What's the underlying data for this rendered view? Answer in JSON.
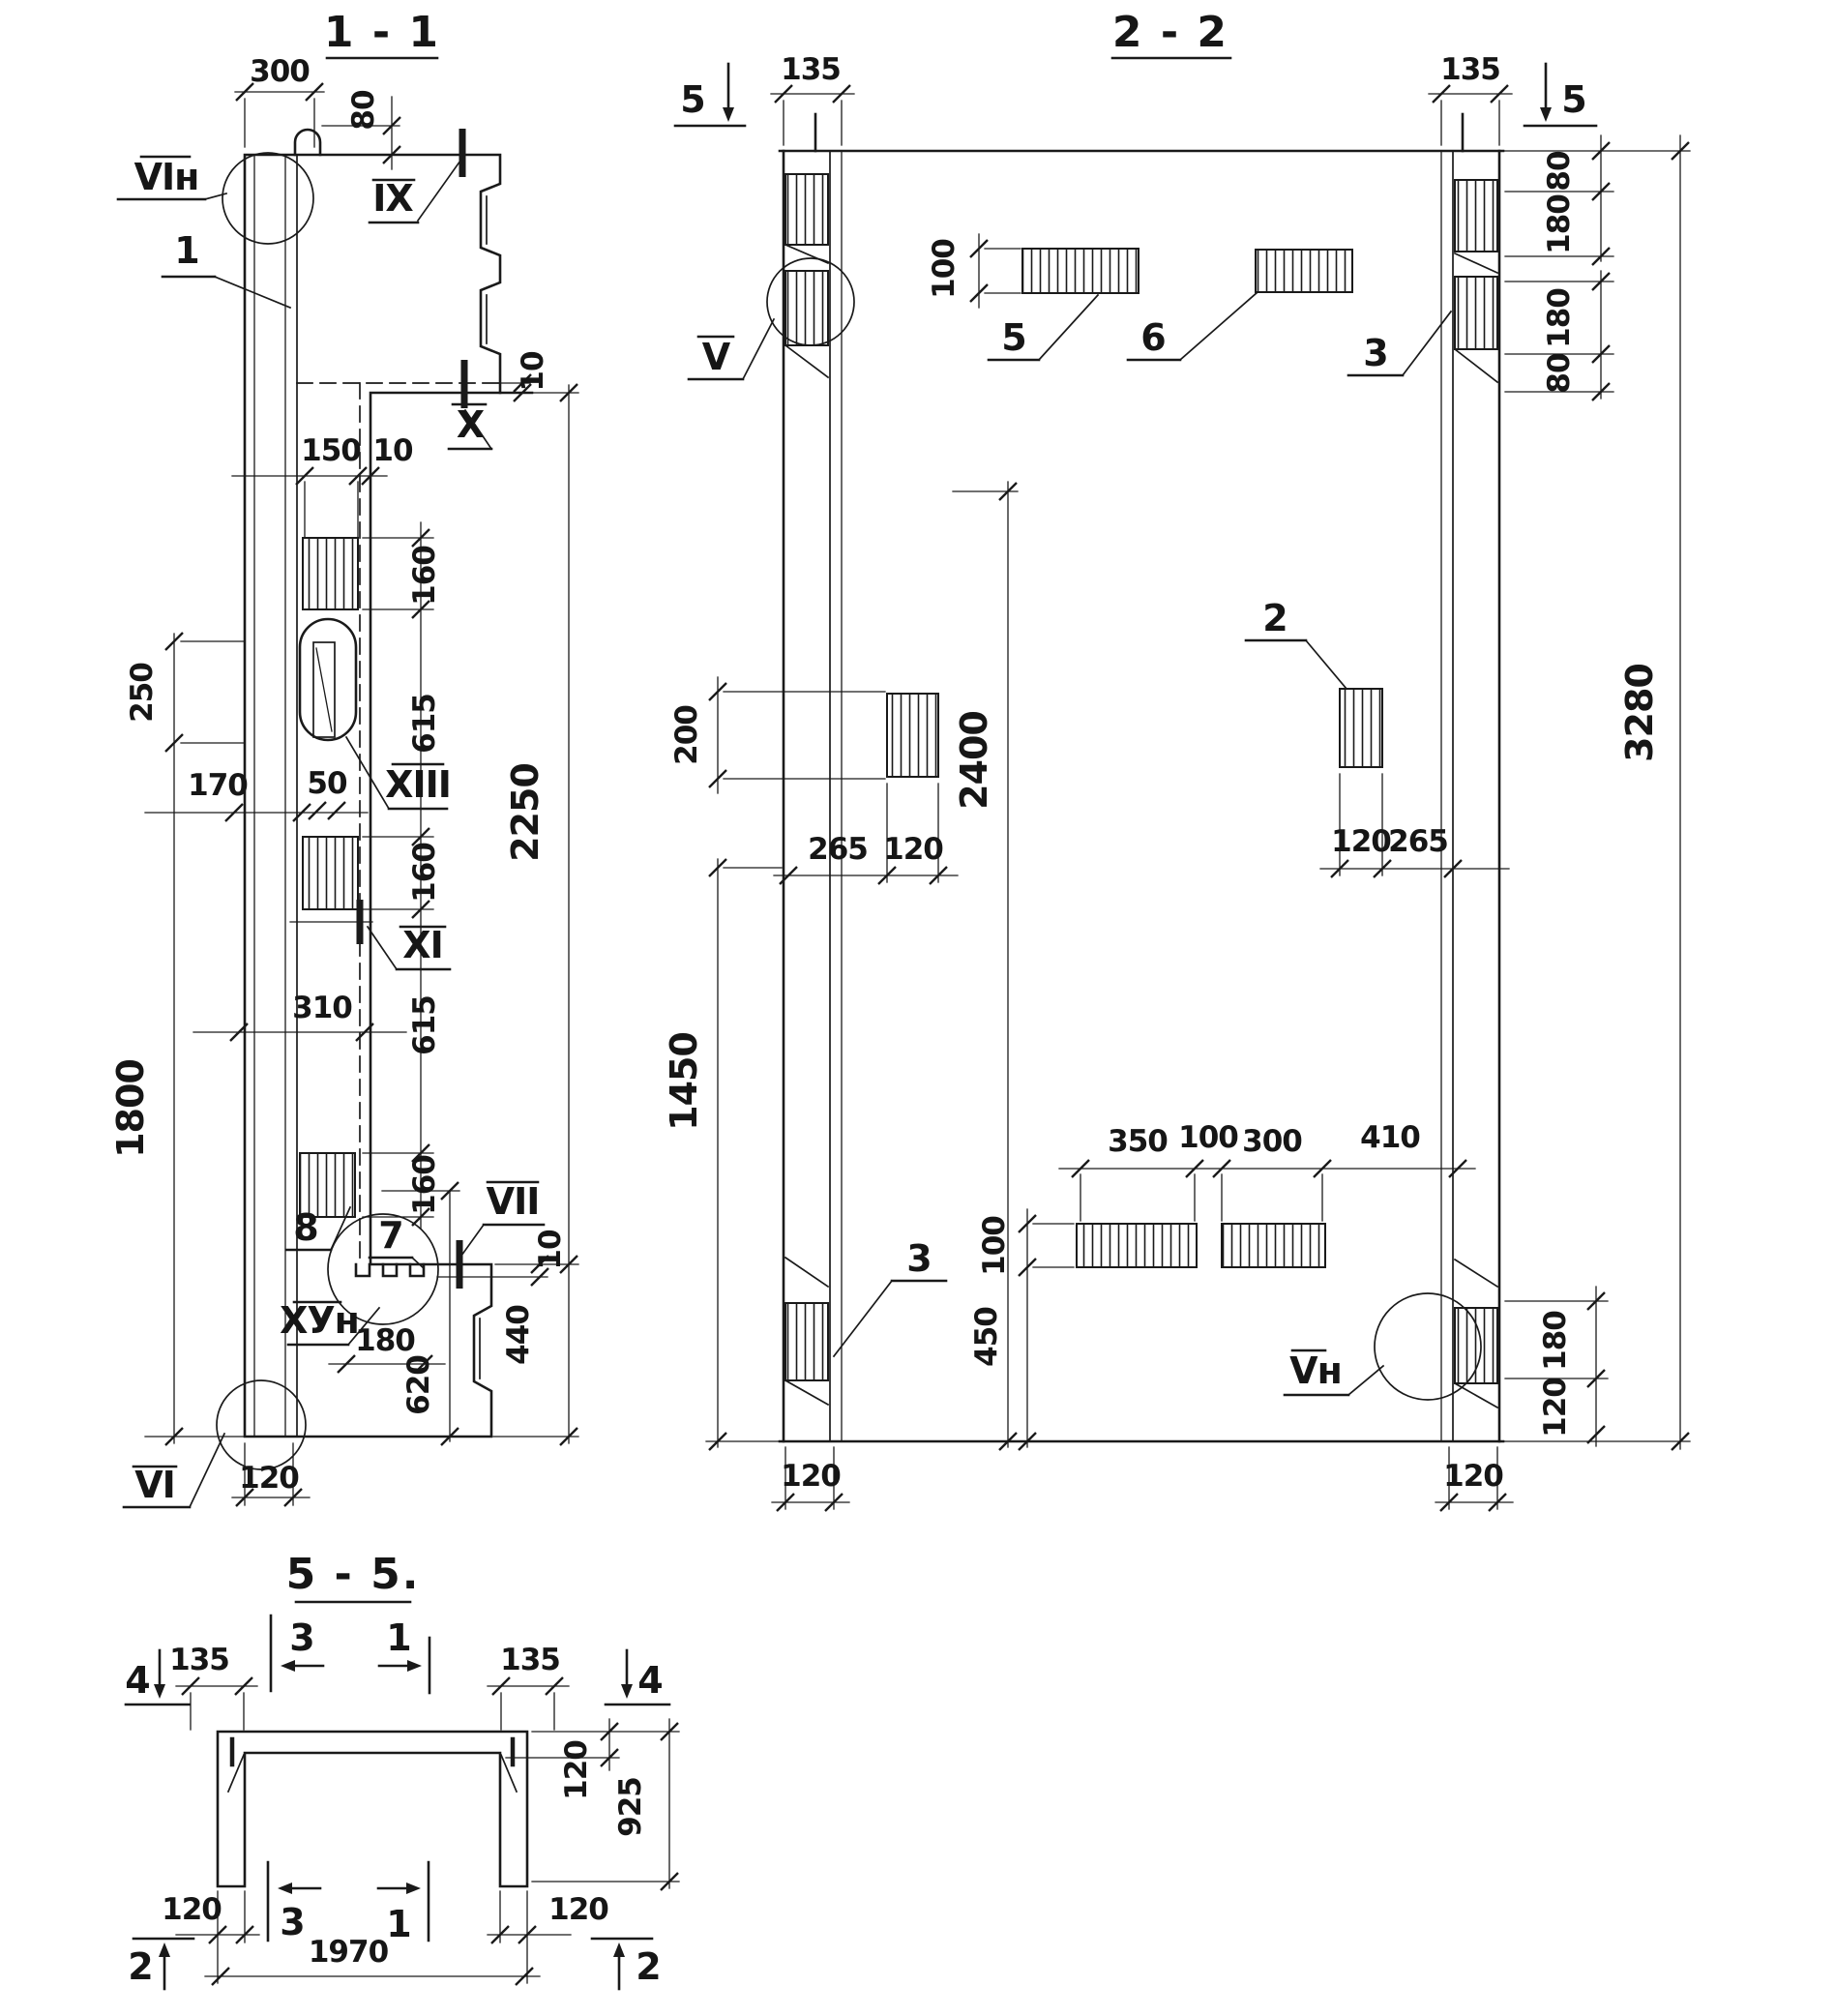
{
  "meta": {
    "ink": "#1a1a1a",
    "paper": "#ffffff",
    "drawing_type": "structural-section-drawing"
  },
  "s11": {
    "title": "1 - 1",
    "d300": "300",
    "d80": "80",
    "d10": "10",
    "d150": "150",
    "d160": "160",
    "d615": "615",
    "d2250": "2250",
    "d50": "50",
    "d250": "250",
    "d170": "170",
    "d310": "310",
    "d1800": "1800",
    "d180": "180",
    "d620": "620",
    "d440": "440",
    "d120": "120",
    "mVIn": "VIн",
    "mIX": "IX",
    "mX": "X",
    "mXIII": "XIII",
    "mXI": "XI",
    "mVII": "VII",
    "mXVn": "ХУн",
    "mVI": "VI",
    "p1": "1",
    "p7": "7",
    "p8": "8"
  },
  "s22": {
    "title": "2 - 2",
    "m5": "5",
    "d135": "135",
    "d80": "80",
    "d180": "180",
    "d100": "100",
    "d200": "200",
    "d265": "265",
    "d120": "120",
    "d2400": "2400",
    "d3280": "3280",
    "d1450": "1450",
    "d350": "350",
    "d300": "300",
    "d410": "410",
    "d450": "450",
    "mV": "V",
    "mVn": "Vн",
    "p2": "2",
    "p3": "3",
    "p5": "5",
    "p6": "6"
  },
  "s55": {
    "title": "5 - 5.",
    "m1": "1",
    "m2": "2",
    "m3": "3",
    "m4": "4",
    "d135": "135",
    "d120": "120",
    "d925": "925",
    "d1970": "1970"
  }
}
